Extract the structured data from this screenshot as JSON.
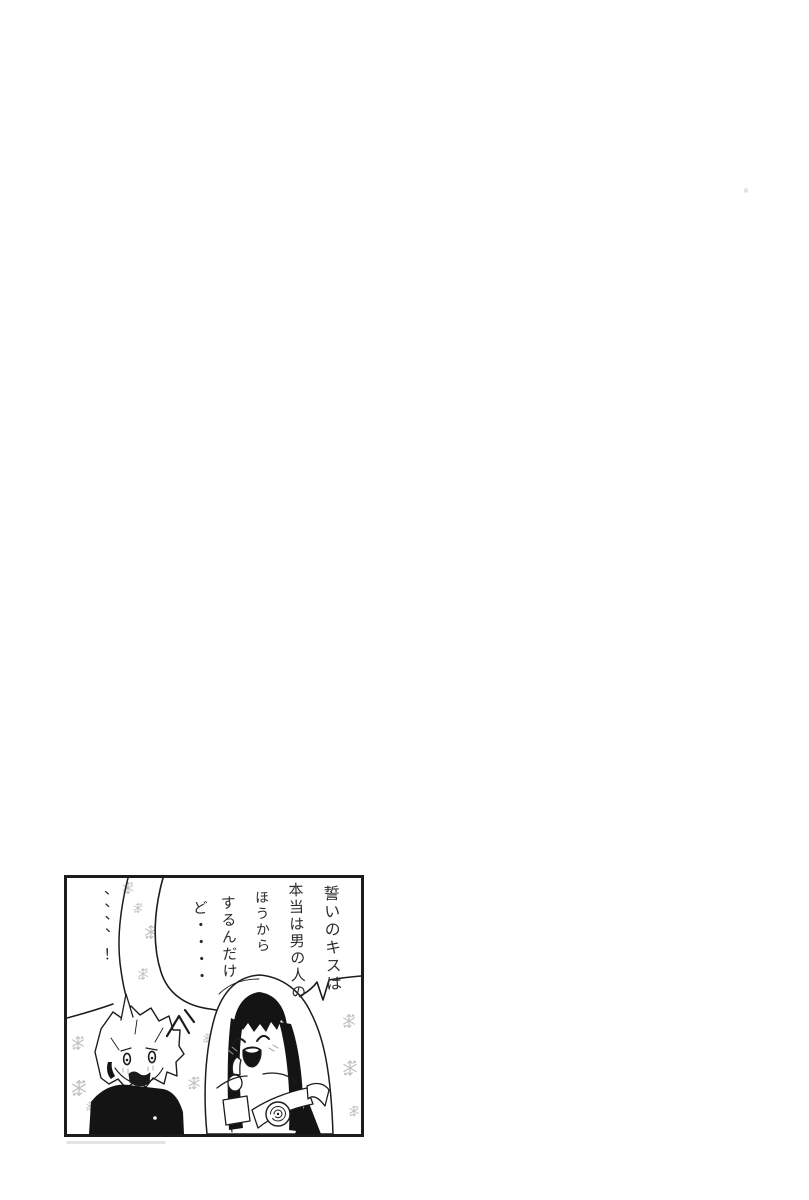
{
  "page": {
    "background_color": "#ffffff",
    "ink_color": "#1c1c1c",
    "sparkle_color": "#c0c0c0"
  },
  "panel": {
    "bubbles": {
      "bride_line": {
        "full_text": "誓いのキスは本当は男の人のほうからするんだけど・・・・",
        "columns": [
          "誓いのキスは",
          "本当は男の人の",
          "ほうから",
          "するんだけ",
          "ど・・・・"
        ]
      },
      "groom_line": {
        "full_text": "、、、、！",
        "columns": [
          "、、、、！"
        ]
      }
    },
    "characters": {
      "groom": "startled spiky-haired boy in dark high-collar suit",
      "bride": "smiling long-haired girl in white wedding veil with rose corsage"
    },
    "motifs": {
      "background": "pale snowflake sparkles",
      "shock_mark": "surprise stroke above groom's head"
    }
  }
}
